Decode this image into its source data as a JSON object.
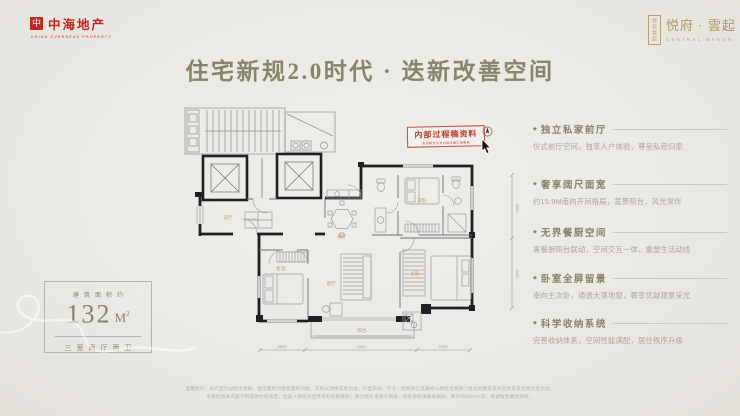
{
  "brand": {
    "logo_mark": "中",
    "logo_text": "中海地产",
    "logo_tagline": "CHINA OVERSEAS PROPERTY",
    "seal_text": "悦府雲起",
    "project_name": "悦府 · 雲起",
    "project_name_en": "CENTRAL MANOR"
  },
  "title": "住宅新规2.0时代 · 迭新改善空间",
  "area_card": {
    "label": "建筑面积约",
    "value": "132",
    "unit": "M",
    "unit_sup": "2",
    "layout": "三室两厅两卫"
  },
  "features": {
    "bullet": "◆",
    "items": [
      {
        "title": "独立私家前厅",
        "desc": "仪式前厅空间，独享入户体验，尊呈私密归家"
      },
      {
        "title": "奢享阔尺面宽",
        "desc": "约15.9M南向开间格局，宽景阳台，风光常伴"
      },
      {
        "title": "无界餐厨空间",
        "desc": "客餐厨阳台联动，空间交互一体，重塑生活动线"
      },
      {
        "title": "卧室全屏留景",
        "desc": "南向主次卧，通透大落地窗，奢享优越观景采光"
      },
      {
        "title": "科学收纳系统",
        "desc": "完善收纳体系，空间性能满配，居住秩序升级"
      }
    ]
  },
  "floor_plan": {
    "stamp": "内部过程稿资料",
    "stamp_note": "本资料仅作为内部过程汇报使用",
    "rooms": [
      "前厅",
      "餐厅",
      "客厅",
      "卧室",
      "次卧",
      "主卧",
      "阳台"
    ],
    "dims_bottom": [
      "3600",
      "7500",
      "2700"
    ],
    "dims_right": [
      "4500",
      "5400"
    ]
  },
  "disclaimer": {
    "line1": "温馨提示：本户型为过程示意稿，图示面积为建筑面积约数，实际以测绘成果为准；户型布局、尺寸、结构等信息最终以政府主管部门批准的图纸及商品房买卖合同约定为准。",
    "line2": "本资料相关内容不构成要约或承诺，出卖人保留对宣传资料的解释权；部分图片来源于网络，如有侵权请联系删除。制作时间2024年，敬请留意最新资料。"
  },
  "colors": {
    "background": "#EBE9E4",
    "olive": "#85856A",
    "brand_red": "#C5251D",
    "gold": "#B29467",
    "stamp_red": "#BF3E2F",
    "plan_ink": "#1F1F24",
    "room_label_orange": "#C49A6D",
    "desc_gray": "#A8A59B"
  }
}
